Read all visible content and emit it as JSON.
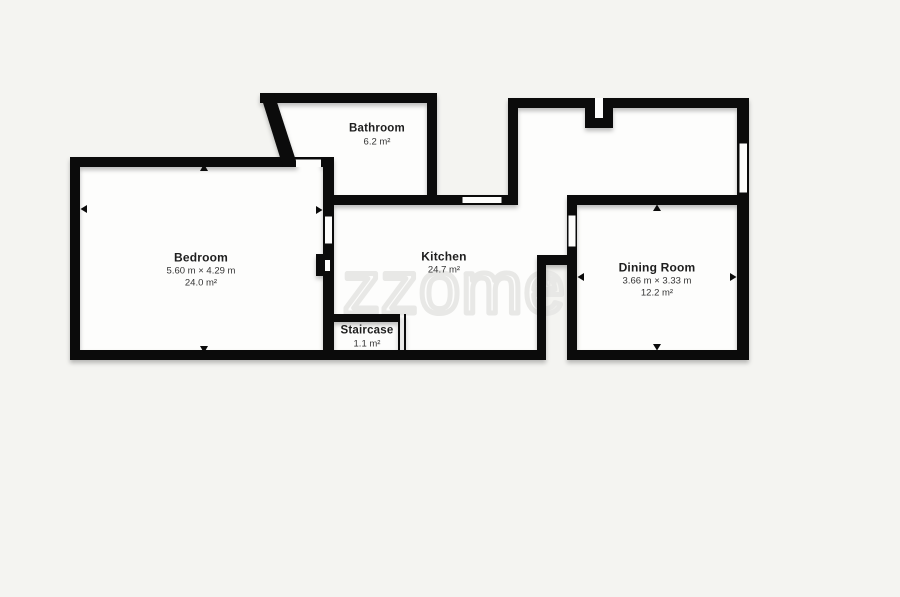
{
  "watermark": {
    "text": "zzome",
    "registered": "®"
  },
  "colors": {
    "background": "#f4f4f1",
    "wall": "#0b0b0b",
    "room_fill": "#fdfdfc",
    "label_text": "#1e1e1e",
    "watermark": "#e8e8e6"
  },
  "rooms": {
    "bathroom": {
      "name": "Bathroom",
      "area": "6.2 m²"
    },
    "bedroom": {
      "name": "Bedroom",
      "dimensions": "5.60 m × 4.29 m",
      "area": "24.0 m²"
    },
    "kitchen": {
      "name": "Kitchen",
      "area": "24.7 m²"
    },
    "staircase": {
      "name": "Staircase",
      "area": "1.1 m²"
    },
    "dining_room": {
      "name": "Dining Room",
      "dimensions": "3.66 m × 3.33 m",
      "area": "12.2 m²"
    }
  }
}
